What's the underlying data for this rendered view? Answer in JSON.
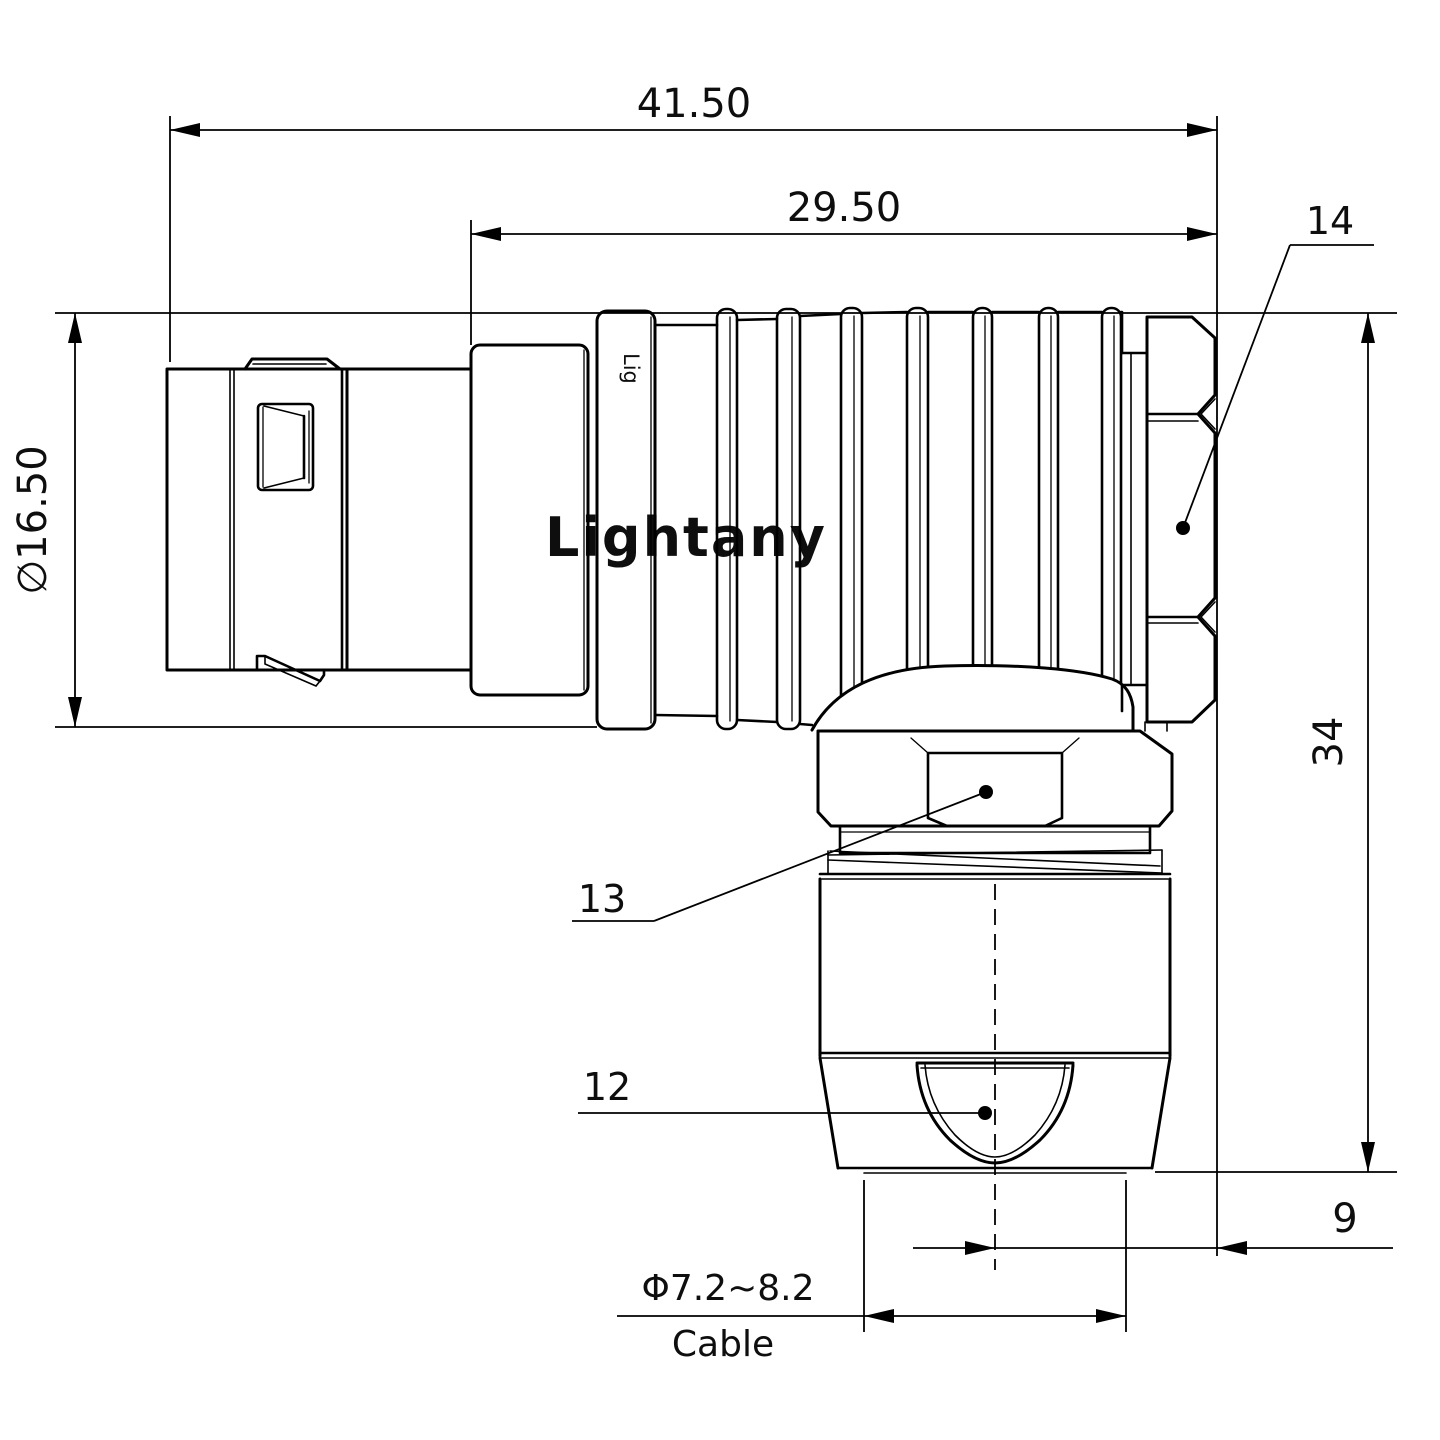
{
  "drawing": {
    "title": "right-angle push-pull connector technical drawing",
    "dimensions": {
      "overall_length": "41.50",
      "rear_length": "29.50",
      "front_diameter": "∅16.50",
      "overall_height": "34",
      "axis_offset": "9",
      "cable_range": "Φ7.2~8.2",
      "cable_word": "Cable"
    },
    "part_labels": {
      "back_nut": "14",
      "hex_nut": "13",
      "cable_clamp": "12"
    },
    "watermark": "Lightany",
    "brand_engraving": "Lig",
    "colors": {
      "line": "#000000",
      "watermark_pink": "#f5c9c9",
      "background": "#ffffff"
    }
  }
}
